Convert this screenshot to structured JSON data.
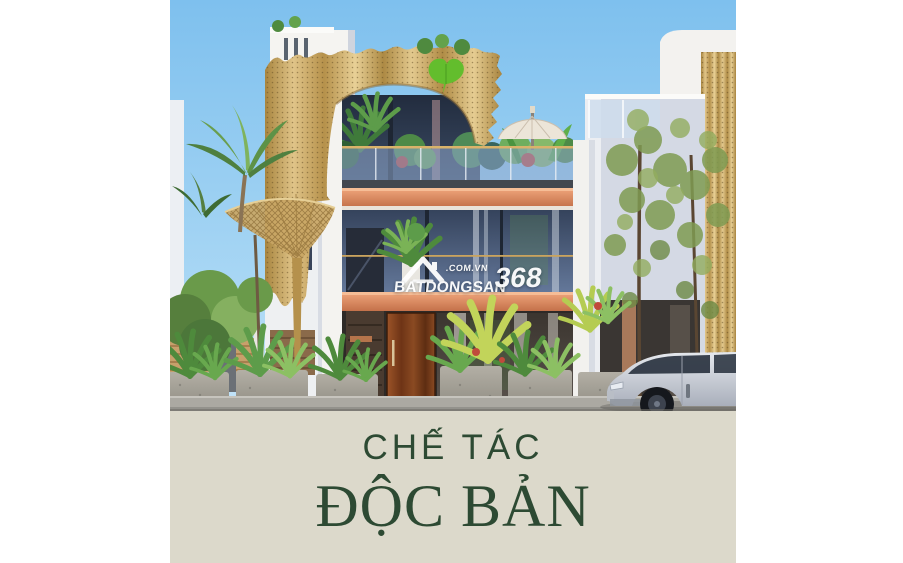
{
  "poster": {
    "watermark": {
      "icon": "house-roof-icon",
      "suffix": ".COM.VN",
      "brand": "BATDONGSAN",
      "number": "368"
    },
    "caption": {
      "line1": "CHẾ TÁC",
      "line2": "ĐỘC BẢN"
    },
    "colors": {
      "page_background": "#ffffff",
      "sky_top": "#7ec0ee",
      "sky_bottom": "#c4e4f8",
      "facade_gold": "#c8a363",
      "fascia_copper": "#cd7c54",
      "leaf_logo_green": "#63bd2d",
      "caption_band_beige": "#dcd9cb",
      "caption_text_green": "#2d4a33",
      "watermark_text": "#ffffff"
    }
  }
}
